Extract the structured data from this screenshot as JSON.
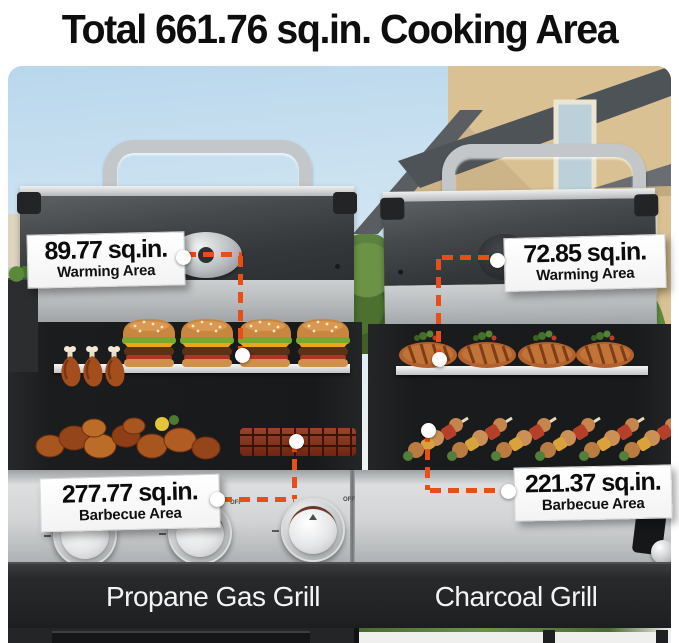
{
  "title": "Total 661.76 sq.in. Cooking Area",
  "callouts": {
    "warming_left": {
      "value": "89.77 sq.in.",
      "label": "Warming Area"
    },
    "warming_right": {
      "value": "72.85 sq.in.",
      "label": "Warming Area"
    },
    "barbecue_left": {
      "value": "277.77 sq.in.",
      "label": "Barbecue Area"
    },
    "barbecue_right": {
      "value": "221.37 sq.in.",
      "label": "Barbecue Area"
    }
  },
  "grill_labels": {
    "left": "Propane Gas Grill",
    "right": "Charcoal Grill"
  },
  "knobs": {
    "off_label": "OFF",
    "count": 3
  },
  "colors": {
    "accent_orange": "#E84E17",
    "title_text": "#0E0E0E",
    "name_band": "#242628",
    "name_text": "#F4F4F4",
    "callout_bg": "#FCFCFC",
    "panel_silver": "#D5D7D8",
    "leader_dot": "#FFFFFF"
  }
}
